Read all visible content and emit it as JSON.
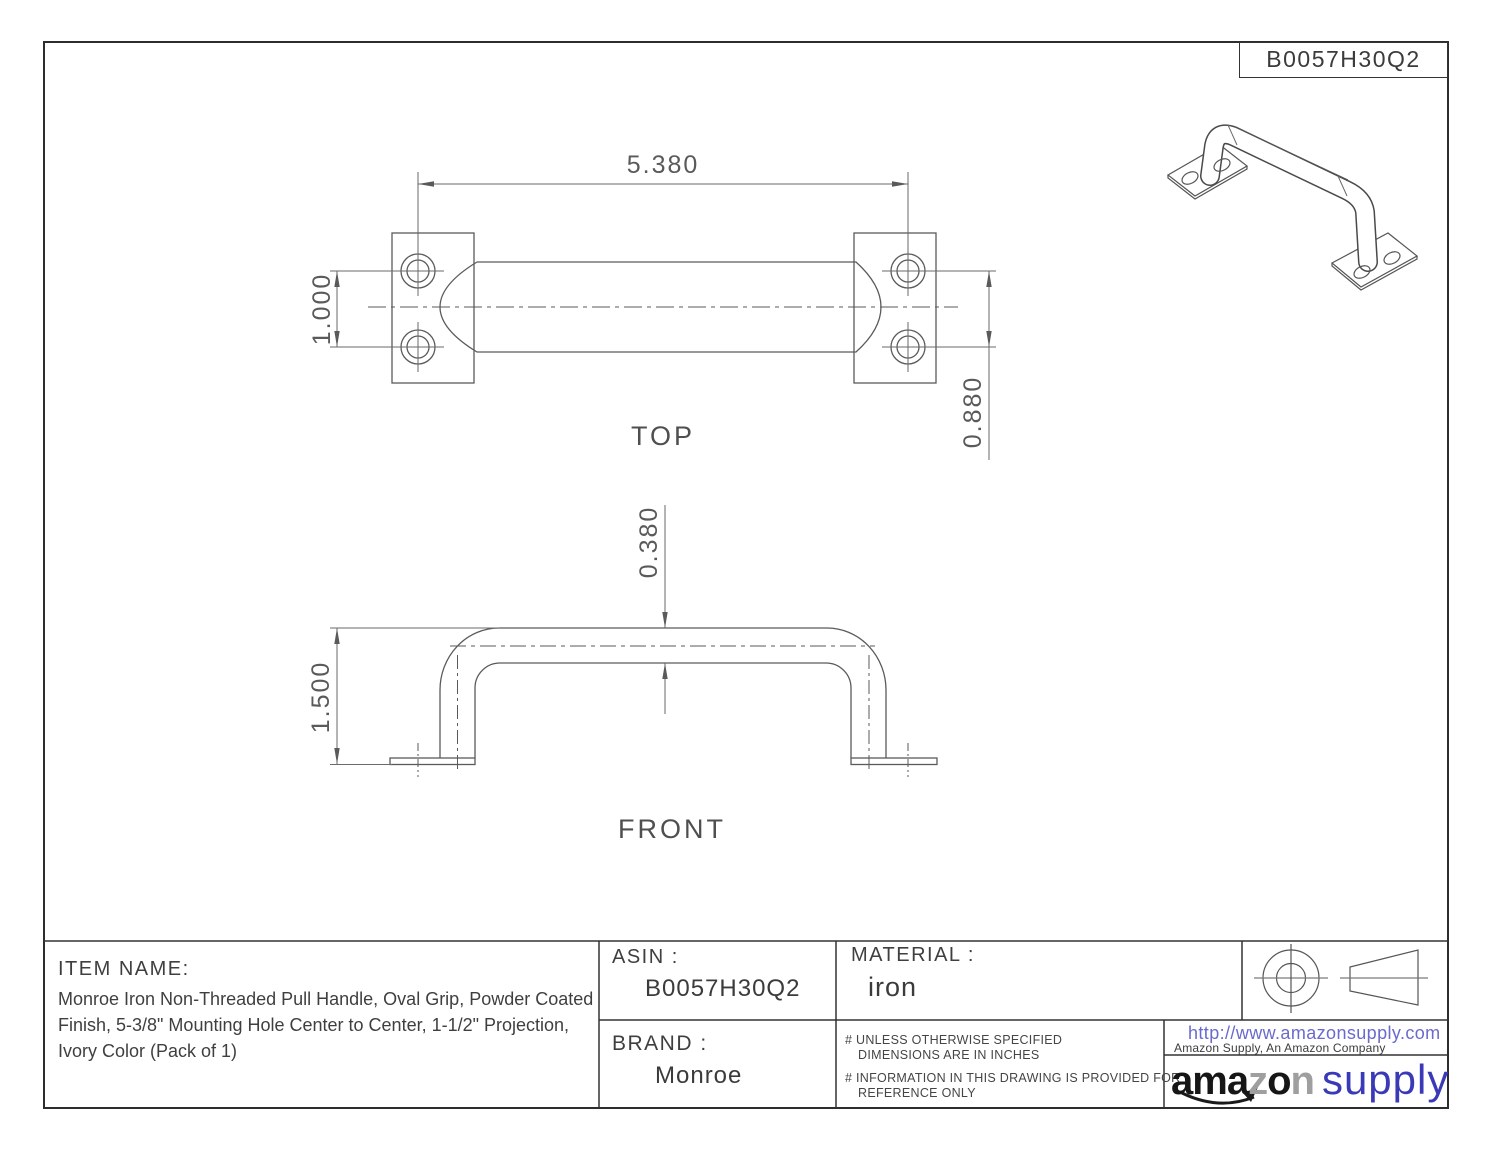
{
  "doc_number": "B0057H30Q2",
  "views": {
    "top": {
      "label": "TOP",
      "dim_width": "5.380",
      "dim_hole_spacing": "1.000",
      "dim_edge_offset": "0.880"
    },
    "front": {
      "label": "FRONT",
      "dim_tube_diameter": "0.380",
      "dim_height": "1.500"
    }
  },
  "title_block": {
    "item_name_label": "ITEM NAME:",
    "item_name": "Monroe Iron Non-Threaded Pull Handle, Oval Grip, Powder Coated Finish, 5-3/8\" Mounting Hole Center to Center, 1-1/2\" Projection, Ivory Color (Pack of 1)",
    "asin_label": "ASIN :",
    "asin": "B0057H30Q2",
    "material_label": "MATERIAL :",
    "material": "iron",
    "brand_label": "BRAND :",
    "brand": "Monroe",
    "note1_line1": "# UNLESS OTHERWISE SPECIFIED",
    "note1_line2": "DIMENSIONS ARE IN INCHES",
    "note2_line1": "# INFORMATION IN THIS DRAWING IS PROVIDED FOR",
    "note2_line2": "REFERENCE ONLY",
    "url": "http://www.amazonsupply.com",
    "company": "Amazon Supply, An Amazon Company",
    "logo": {
      "part1": "ama",
      "part2": "z",
      "part3": "o",
      "part4": "n",
      "part5": "supply"
    }
  },
  "colors": {
    "url_blue": "#6a6acd",
    "logo_blue": "#3a3ab8",
    "drawing_line": "#5a5a5a",
    "block_line": "#333333",
    "border_line": "#2d2d2d"
  }
}
